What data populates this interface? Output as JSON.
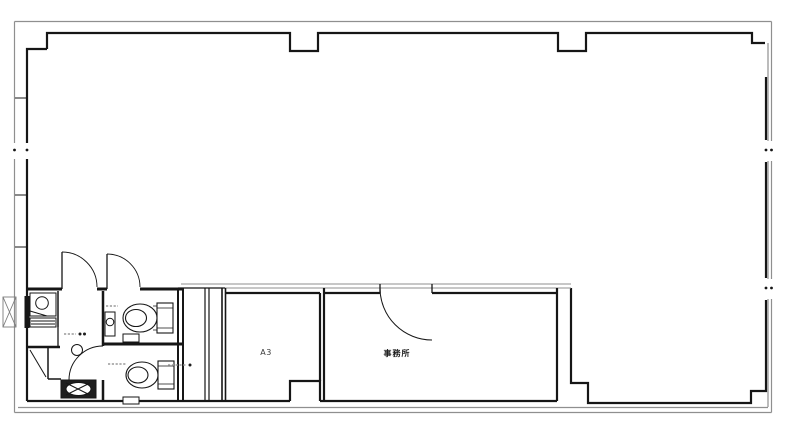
{
  "drawing": {
    "labels": {
      "room_a3": "A3",
      "room_office": "事務所"
    },
    "colors": {
      "wall": "#161616",
      "outer_boundary": "#8f8f8f",
      "background": "#ffffff",
      "annotation": "#9a9a9a"
    }
  }
}
